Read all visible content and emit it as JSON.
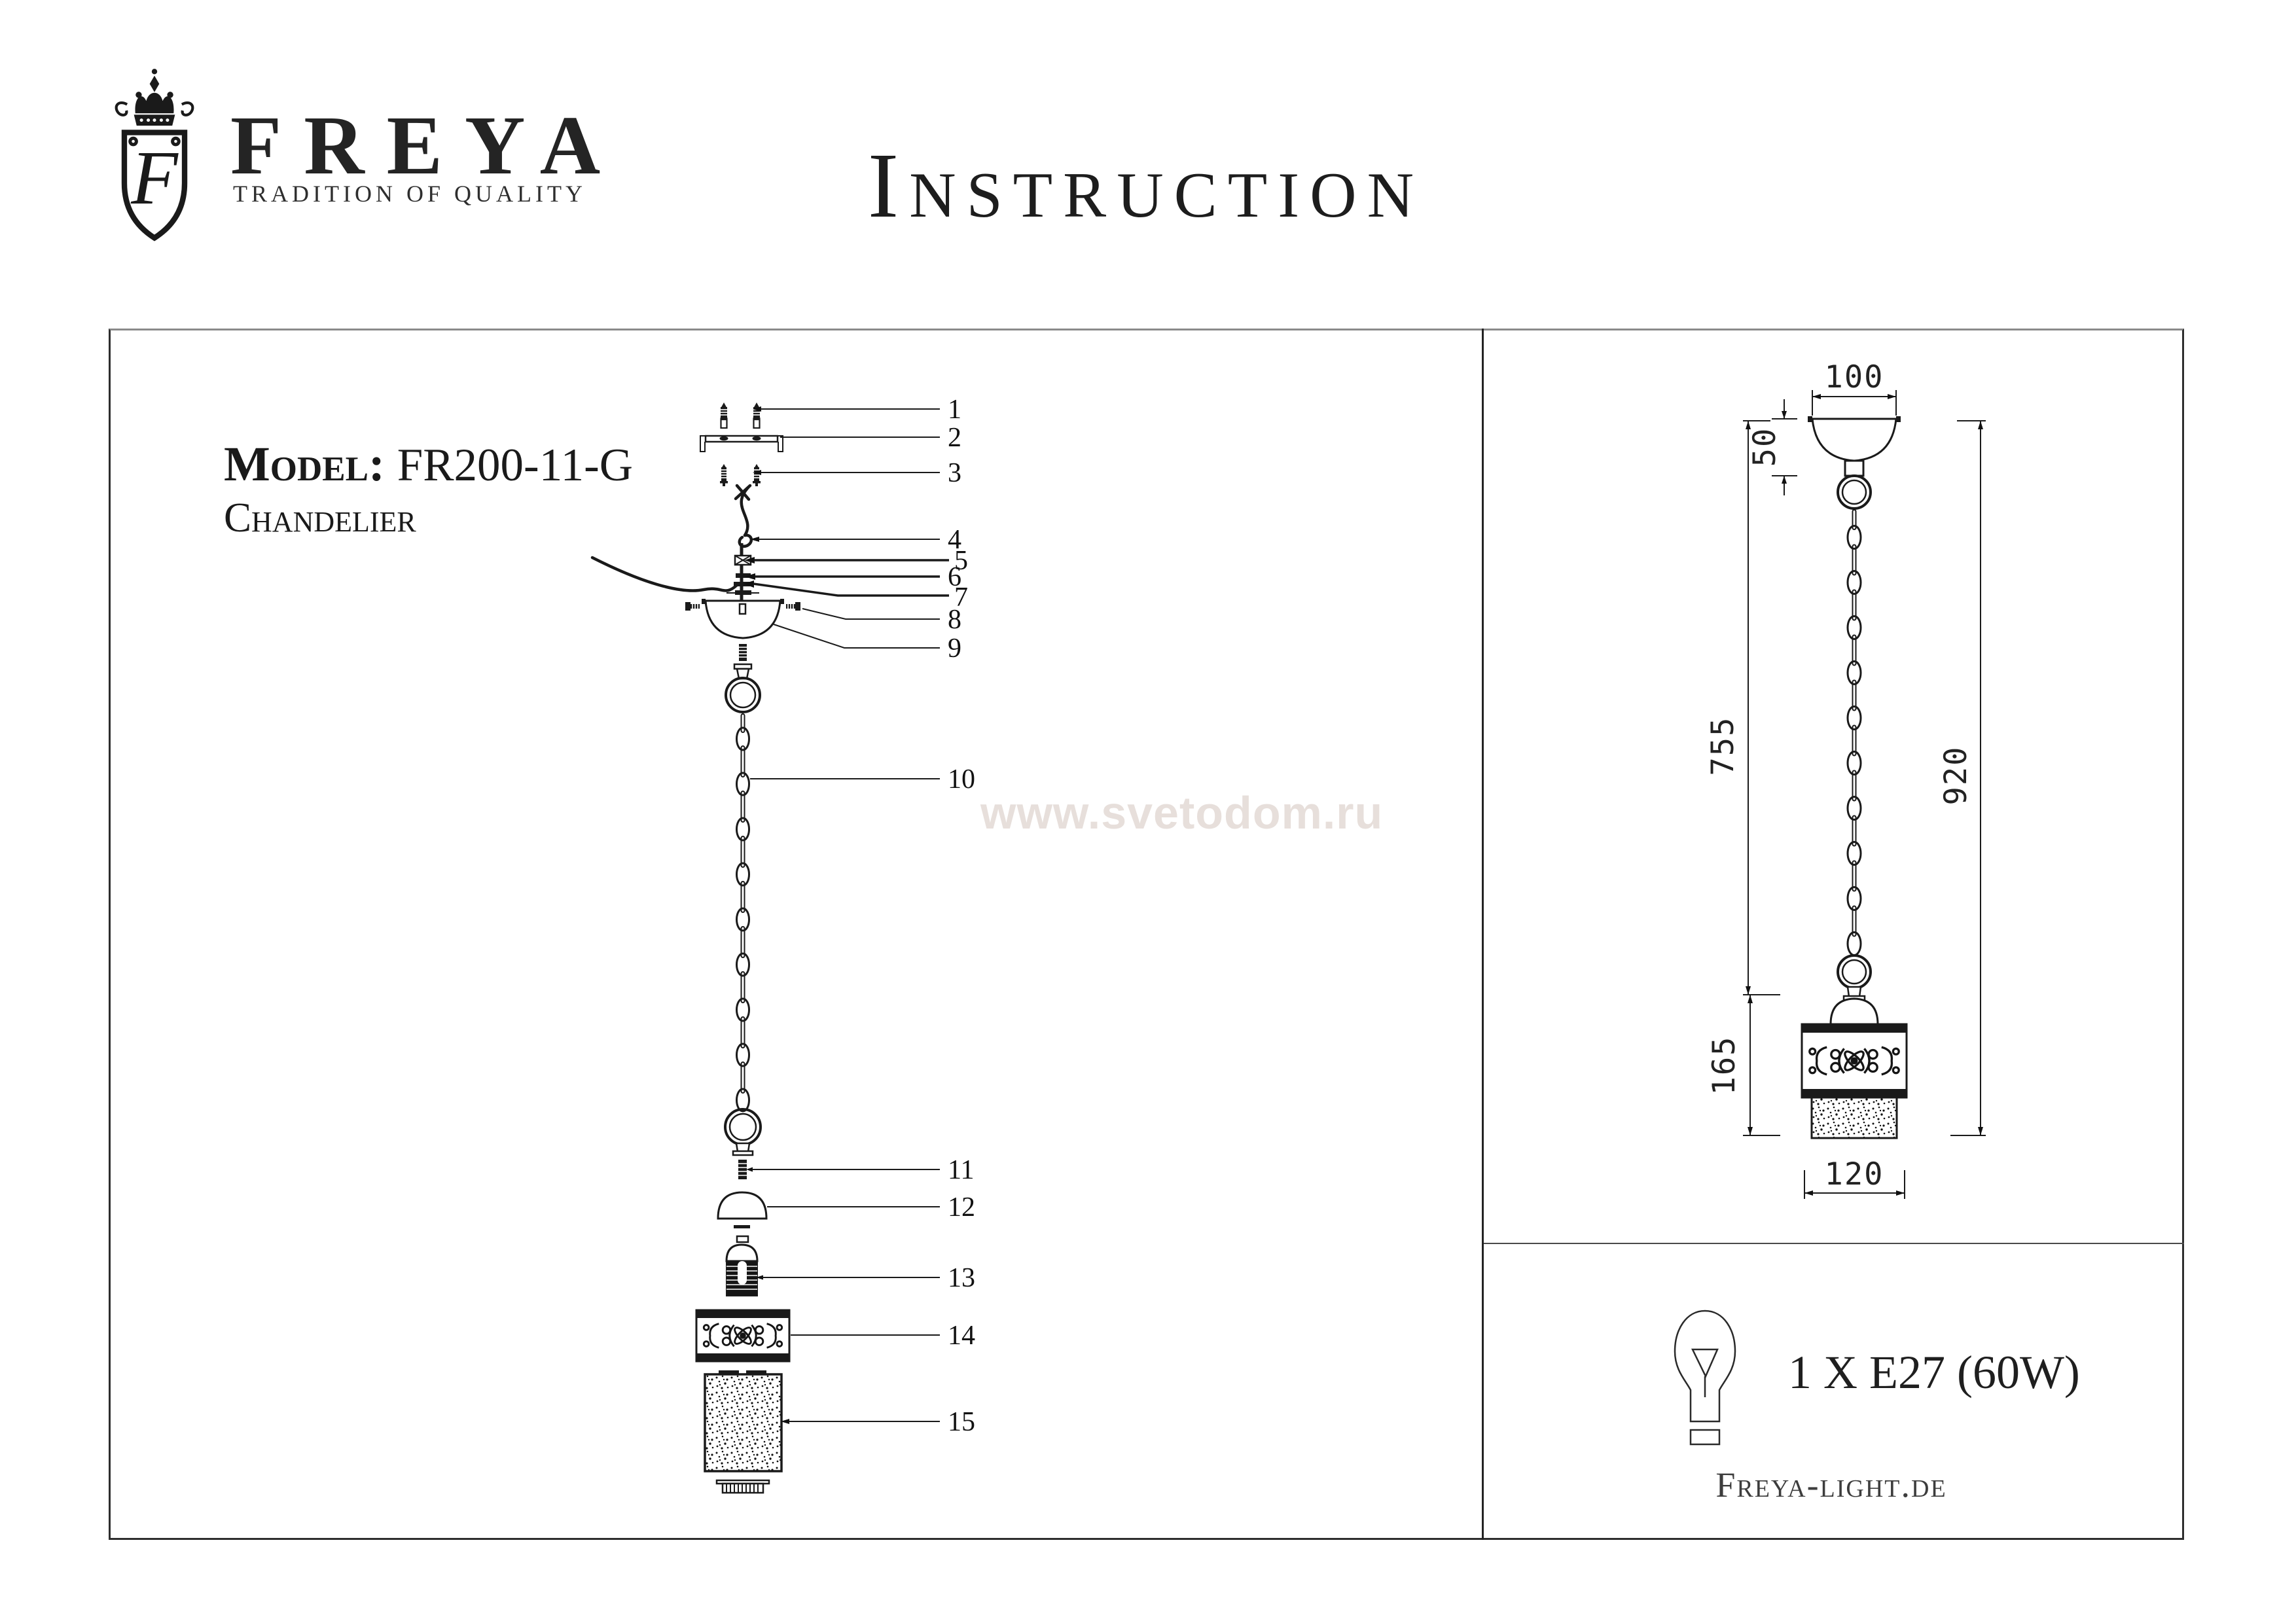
{
  "logo": {
    "monogram": "F",
    "brand": "FREYA",
    "tagline": "TRADITION OF QUALITY"
  },
  "title": "Instruction",
  "model": {
    "label": "Model:",
    "value": "FR200-11-G",
    "type": "Chandelier"
  },
  "watermark": "www.svetodom.ru",
  "parts": {
    "labels": [
      "1",
      "2",
      "3",
      "4",
      "5",
      "6",
      "7",
      "8",
      "9",
      "10",
      "11",
      "12",
      "13",
      "14",
      "15"
    ]
  },
  "dimensions": {
    "canopy_width": "100",
    "canopy_height": "50",
    "chain_length": "755",
    "total_height": "920",
    "shade_height": "165",
    "shade_width": "120"
  },
  "spec": {
    "bulb": "1 X E27 (60W)",
    "website": "Freya-light.de"
  }
}
